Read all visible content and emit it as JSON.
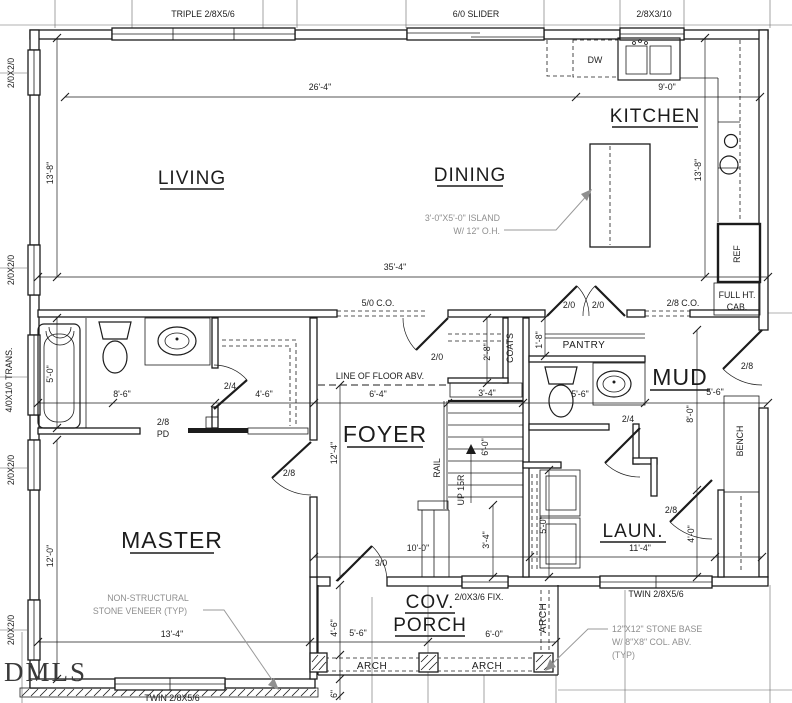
{
  "watermark": "DMLS",
  "rooms": {
    "living": "LIVING",
    "dining": "DINING",
    "kitchen": "KITCHEN",
    "master": "MASTER",
    "foyer": "FOYER",
    "mud": "MUD",
    "laundry": "LAUN.",
    "pantry": "PANTRY",
    "coats": "COATS",
    "porch_line1": "COV.",
    "porch_line2": "PORCH"
  },
  "windows": {
    "triple": "TRIPLE 2/8X5/6",
    "slider": "6/0 SLIDER",
    "single": "2/8X3/10",
    "twin": "TWIN 2/8X5/6",
    "casement": "2/0X2/0",
    "transom": "4/0X1/0 TRANS.",
    "fixed": "2/0X3/6 FIX."
  },
  "doors": {
    "d2_0": "2/0",
    "d2_4": "2/4",
    "d2_8": "2/8",
    "d3_0": "3/0",
    "pocket": "PD"
  },
  "openings": {
    "co_5_0": "5/0 C.O.",
    "co_2_8": "2/8 C.O.",
    "arch": "ARCH"
  },
  "fixtures": {
    "dw": "DW",
    "ref": "REF",
    "bench": "BENCH",
    "full_ht_line1": "FULL HT.",
    "full_ht_line2": "CAB.",
    "rail": "RAIL",
    "up": "UP 15R"
  },
  "dims": {
    "d26_4": "26'-4\"",
    "d9_0": "9'-0\"",
    "d35_4": "35'-4\"",
    "d13_8": "13'-8\"",
    "d8_6": "8'-6\"",
    "d4_6": "4'-6\"",
    "d6_4": "6'-4\"",
    "d3_4": "3'-4\"",
    "d5_6": "5'-6\"",
    "d5_0": "5'-0\"",
    "d2_8": "2'-8\"",
    "d1_8": "1'-8\"",
    "d12_4": "12'-4\"",
    "d12_0": "12'-0\"",
    "d6_0": "6'-0\"",
    "d8_0": "8'-0\"",
    "d10_0": "10'-0\"",
    "d11_4": "11'-4\"",
    "d13_4": "13'-4\"",
    "d4_0": "4'-0\"",
    "d6in": "6\""
  },
  "notes": {
    "floor_abv": "LINE OF FLOOR ABV.",
    "island_line1": "3'-0\"X5'-0\" ISLAND",
    "island_line2": "W/ 12\" O.H.",
    "stone_line1": "NON-STRUCTURAL",
    "stone_line2": "STONE VENEER (TYP)",
    "base_line1": "12\"X12\" STONE BASE",
    "base_line2": "W/ 8\"X8\" COL. ABV.",
    "base_line3": "(TYP)"
  },
  "colors": {
    "line": "#1c1c1c",
    "annotation": "#8f8f8f",
    "watermark": "#3a3a3a",
    "background": "#ffffff"
  }
}
